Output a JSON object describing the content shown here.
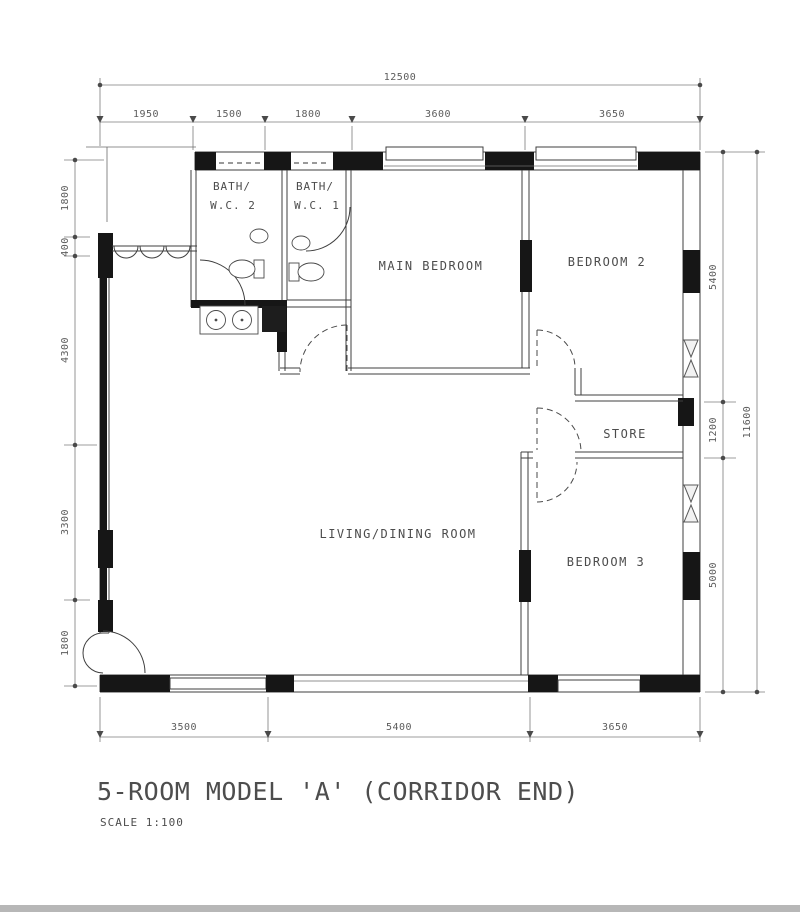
{
  "plan": {
    "title": "5-ROOM MODEL 'A' (CORRIDOR END)",
    "scale_label": "SCALE 1:100",
    "rooms": {
      "bath2_line1": "BATH/",
      "bath2_line2": "W.C. 2",
      "bath1_line1": "BATH/",
      "bath1_line2": "W.C. 1",
      "main_bedroom": "MAIN BEDROOM",
      "bedroom2": "BEDROOM 2",
      "store": "STORE",
      "living_dining": "LIVING/DINING ROOM",
      "bedroom3": "BEDROOM 3"
    },
    "dimensions": {
      "top_total": "12500",
      "top": [
        "1950",
        "1500",
        "1800",
        "3600",
        "3650"
      ],
      "left": [
        "1800",
        "400",
        "4300",
        "3300",
        "1800"
      ],
      "right": [
        "5400",
        "1200",
        "5000"
      ],
      "right_total": "11600",
      "bottom": [
        "3500",
        "5400",
        "3650"
      ]
    },
    "colors": {
      "ink": "#3f3f3f",
      "wall": "#161616",
      "dim_text": "#5c5c5c"
    }
  }
}
